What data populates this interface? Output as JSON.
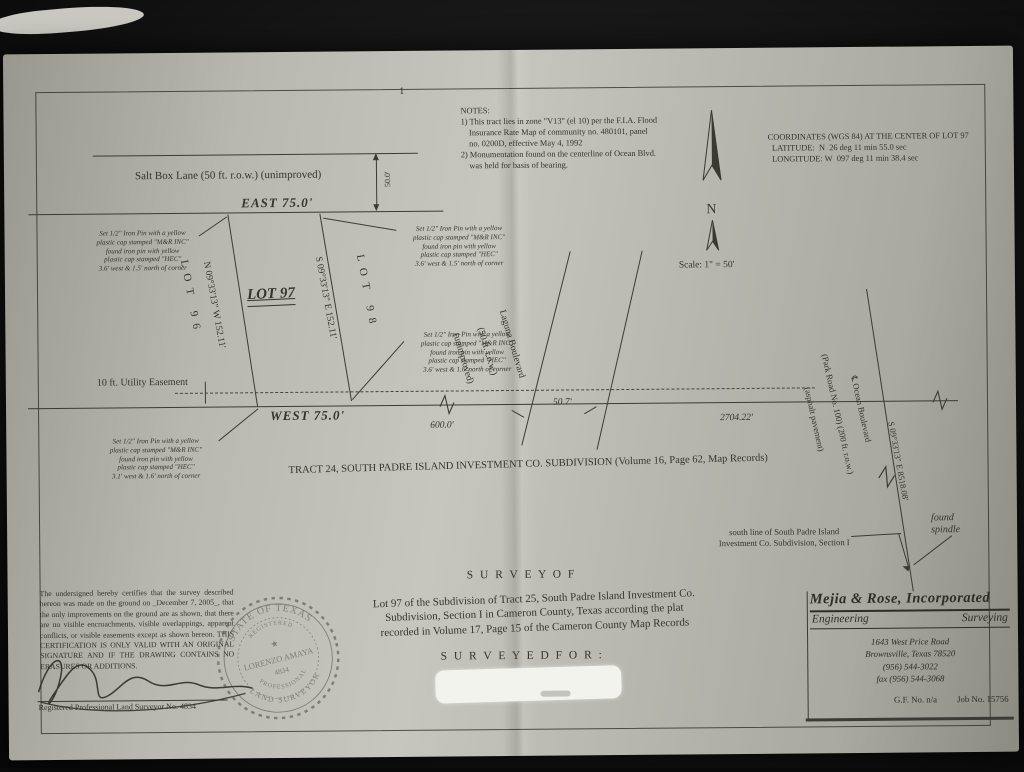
{
  "notes": {
    "text": "NOTES:\n1) This tract lies in zone \"V13\" (el 10) per the F.I.A. Flood\n    Insurance Rate Map of community no. 480101, panel\n    no. 0200D, effective May 4, 1992\n2) Monumentation found on the centerline of Ocean Blvd.\n    was held for basis of bearing."
  },
  "coordinates": {
    "text": "COORDINATES (WGS 84) AT THE CENTER OF LOT 97\n  LATITUDE:  N  26 deg 11 min 55.0 sec\n  LONGITUDE: W  097 deg 11 min 38.4 sec"
  },
  "north_arrow": {
    "label": "N"
  },
  "scale": {
    "text": "Scale: 1\" = 50'"
  },
  "streets": {
    "salt_box": "Salt Box Lane (50 ft. r.o.w.) (unimproved)",
    "laguna_line1": "Laguna Boulevard",
    "laguna_line2": "(50 ft. r.o.w.)",
    "laguna_line3": "(unimproved)",
    "ocean_line1": "℄ Ocean Boulevard",
    "ocean_line2": "(Park Road No. 100) (200 ft. r.o.w.)",
    "ocean_line3": "(asphalt pavement)"
  },
  "lot": {
    "lot96": "LOT 96",
    "lot97": "LOT 97",
    "lot98": "LOT 98",
    "bearing_west_side": "N 09°33'13\" W   152.11'",
    "bearing_east_side": "S 09°33'13\" E   152.11'",
    "east_dim": "EAST   75.0'",
    "west_dim": "WEST   75.0'",
    "row_width": "50.0'",
    "easement": "10 ft. Utility Easement"
  },
  "dimensions": {
    "d600": "600.0'",
    "d50_7": "50.7'",
    "d2704": "2704.22'",
    "ocean_bearing": "S 09°33'13\" E  8518.08'"
  },
  "pins": {
    "top_left": "Set 1/2\" Iron Pin with a yellow\nplastic cap stamped \"M&R INC\"\nfound iron pin with yellow\nplastic cap stamped \"HEC\"\n3.6' west & 1.5' north of corner",
    "top_right": "Set 1/2\" Iron Pin with a yellow\nplastic cap stamped \"M&R INC\"\nfound iron pin with yellow\nplastic cap stamped \"HEC\"\n3.6' west & 1.5' north of corner",
    "mid_right": "Set 1/2\" Iron Pin with a yellow\nplastic cap stamped \"M&R INC\"\nfound iron pin with yellow\nplastic cap stamped \"HEC\"\n3.6' west & 1.6' north of corner",
    "bottom_left": "Set 1/2\" Iron Pin with a yellow\nplastic cap stamped \"M&R INC\"\nfound iron pin with yellow\nplastic cap stamped \"HEC\"\n3.1' west & 1.6' north of corner"
  },
  "annotations": {
    "tract": "TRACT 24, SOUTH PADRE ISLAND INVESTMENT CO. SUBDIVISION (Volume 16, Page 62, Map Records)",
    "south_line": "south line of South Padre Island\nInvestment Co. Subdivision, Section I",
    "found_spindle": "found\nspindle",
    "top_mark": "1"
  },
  "certification": {
    "body": "The undersigned hereby certifies that the survey described hereon was made on the ground on _December 7, 2005_, that the only improvements on the ground are as shown, that there are no visible encroachments, visible overlappings, apparent conflicts, or visible easements except as shown hereon.  THIS CERTIFICATION IS ONLY VALID WITH AN ORIGINAL SIGNATURE AND IF THE DRAWING CONTAINS NO ERASURES OR ADDITIONS.",
    "signer": "Registered Professional Land Surveyor No. 4834"
  },
  "seal": {
    "top": "STATE OF TEXAS",
    "sub": "REGISTERED",
    "star": "★",
    "name": "LORENZO AMAYA",
    "number": "4834",
    "bottom1": "PROFESSIONAL",
    "bottom2": "LAND SURVEYOR"
  },
  "title_block": {
    "survey_of": "S U R V E Y   O F",
    "description": "Lot 97 of the Subdivision of Tract 25, South Padre Island Investment Co.\nSubdivision, Section I in Cameron County, Texas according the plat\nrecorded in Volume 17, Page 15 of the Cameron County Map Records",
    "surveyed_for": "S U R V E Y E D   F O R :"
  },
  "firm": {
    "name": "Mejia & Rose, Incorporated",
    "dept_left": "Engineering",
    "dept_right": "Surveying",
    "address": "1643 West Price Road\nBrownsville, Texas  78520\n(956) 544-3022\nfax (956) 544-3068",
    "gf_no": "G.F. No.  n/a",
    "job_no": "Job No. 15756"
  },
  "colors": {
    "paper": "#b9b9b1",
    "ink": "#35332d",
    "background": "#0b0b0b"
  }
}
